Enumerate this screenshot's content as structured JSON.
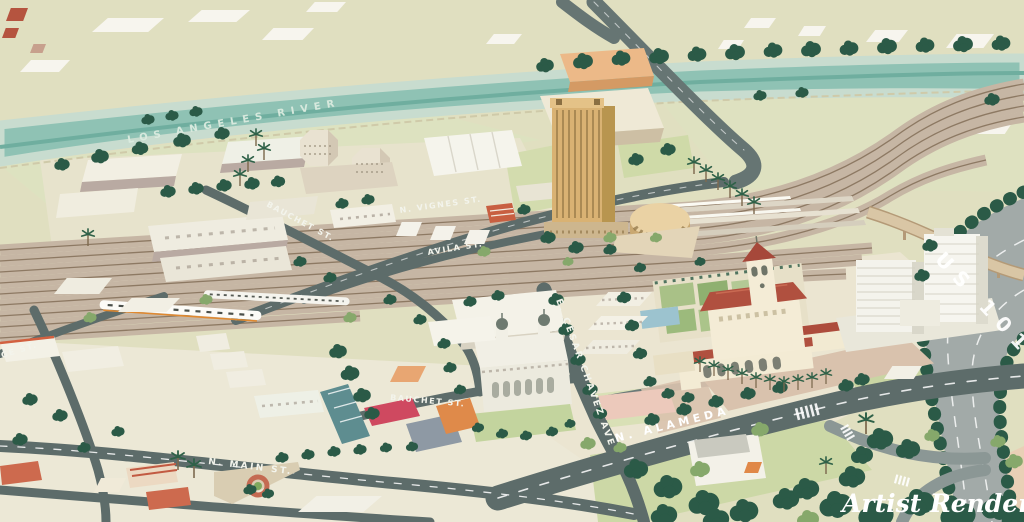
{
  "map": {
    "type": "illustrated-aerial-map",
    "labels": {
      "river": "LOS ANGELES RIVER",
      "highway": "US 101",
      "vignes": "N. VIGNES ST.",
      "avila": "AVILA ST.",
      "bauchet_north": "BAUCHET ST.",
      "bauchet_south": "BAUCHET ST.",
      "cesar_chavez": "E. CESAR CHAVEZ AVE",
      "alameda": "N. ALAMEDA",
      "main": "N. MAIN ST.",
      "left_edge_partial": "GE ST.",
      "credit": "Artist Rendering"
    },
    "colors": {
      "background": "#e0dfc0",
      "river": "#8fc2b4",
      "road": "#5d6c6a",
      "freeway": "#a2aaa8",
      "rail": "#8d7963",
      "tree": "#2b5a47",
      "station_roof": "#b0503f",
      "station_wall": "#f2e9d2",
      "gold_tower": "#d9b273",
      "label_text": "#ffffff"
    }
  }
}
